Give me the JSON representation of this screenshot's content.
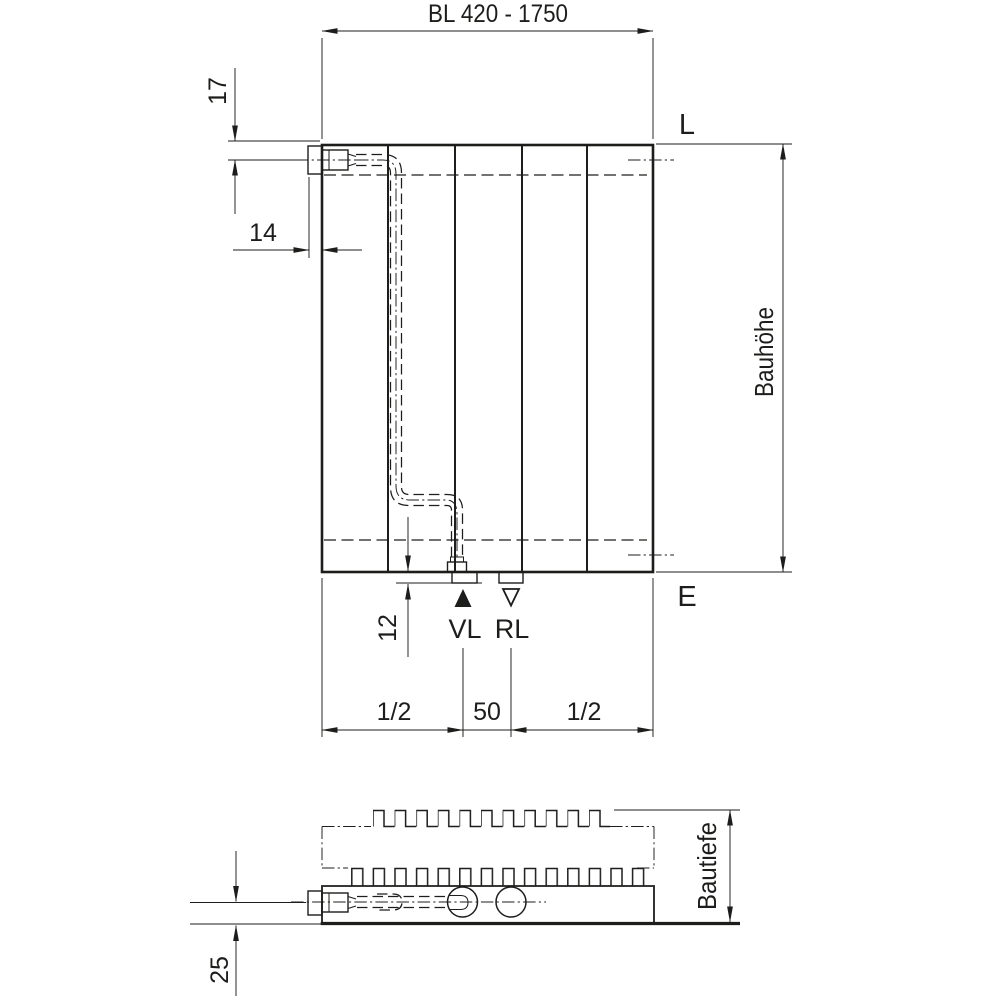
{
  "front_view": {
    "dim_bl": "BL 420 - 1750",
    "dim_17": "17",
    "dim_14": "14",
    "dim_12": "12",
    "dim_half_left": "1/2",
    "dim_50": "50",
    "dim_half_right": "1/2",
    "label_bauhoehe": "Bauhöhe",
    "label_l": "L",
    "label_e": "E",
    "label_vl": "VL",
    "label_rl": "RL"
  },
  "top_view": {
    "label_bautiefe": "Bautiefe",
    "dim_25": "25"
  },
  "colors": {
    "line": "#1d1d1b",
    "background": "#ffffff"
  }
}
